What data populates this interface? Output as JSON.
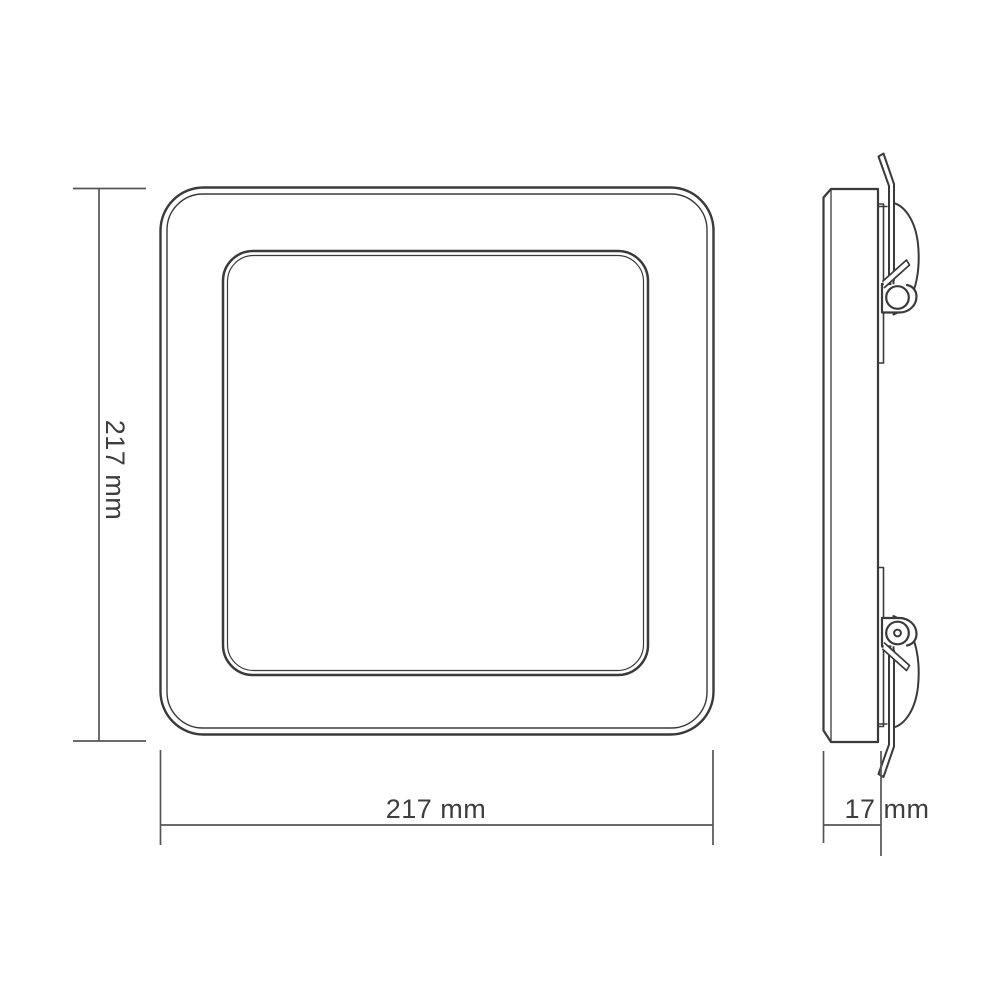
{
  "drawing": {
    "views": {
      "front": {
        "height_label": "217 mm",
        "width_label": "217 mm"
      },
      "side": {
        "depth_label": "17 mm"
      }
    }
  },
  "colors": {
    "background": "#ffffff",
    "outline": "#3a3a3a",
    "dimension_line": "#555555",
    "label_text": "#3e3e3e"
  }
}
